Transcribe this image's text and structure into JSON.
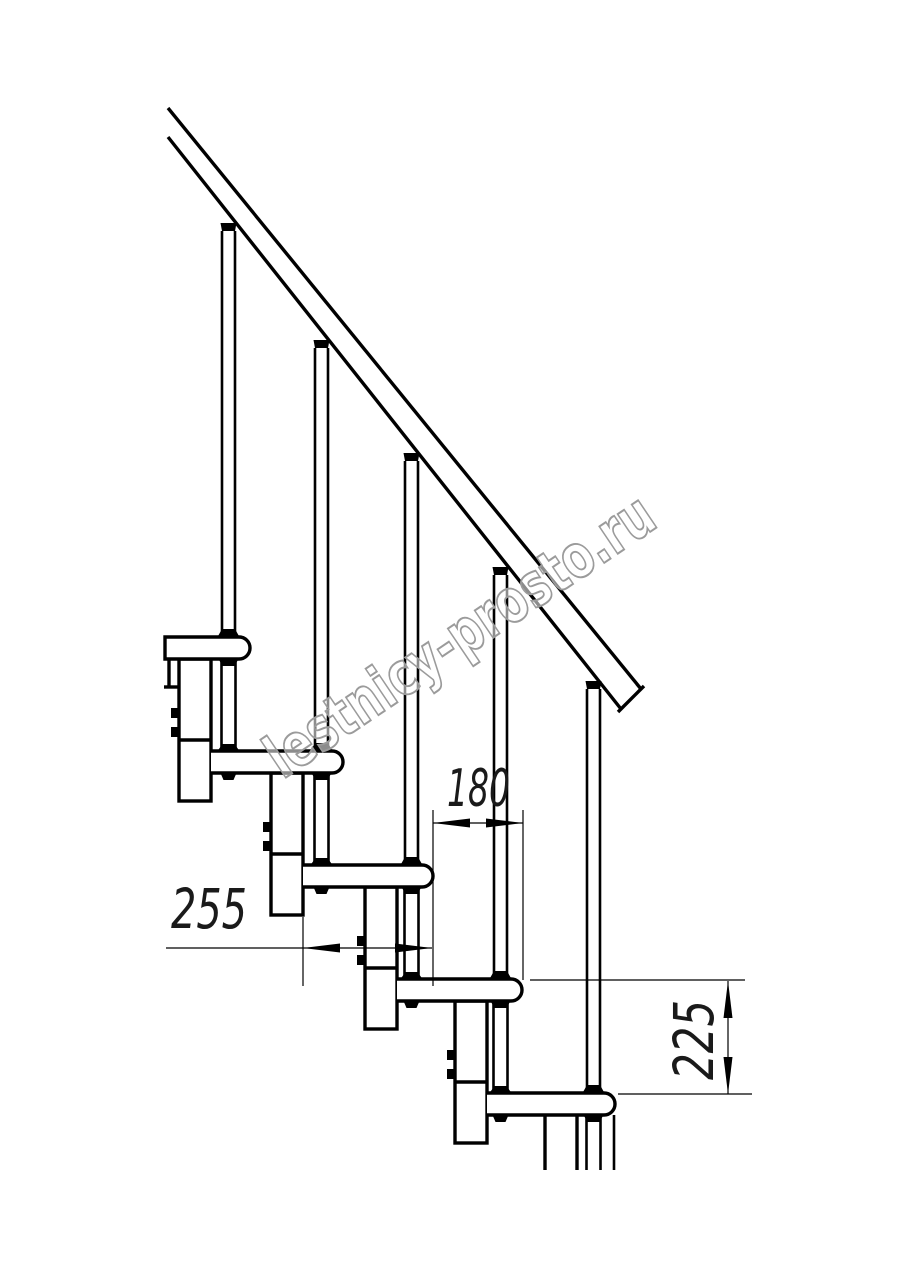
{
  "drawing": {
    "type": "modular-staircase-side-view",
    "dimensions": {
      "step_run_180": "180",
      "tread_depth_255": "255",
      "step_height_225": "225"
    },
    "watermark": "lestnicy-prosto.ru",
    "colors": {
      "line": "#000000",
      "background": "#ffffff",
      "watermark_outline": "#9b9b9b"
    }
  }
}
